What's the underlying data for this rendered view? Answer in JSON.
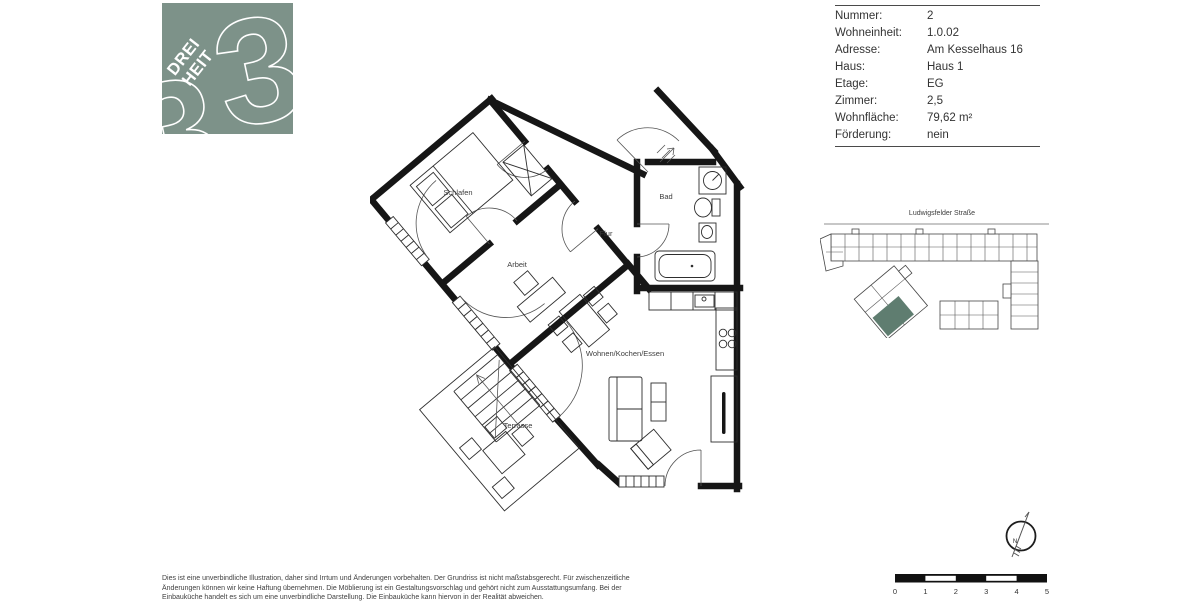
{
  "colors": {
    "logo_green": "#7D9289",
    "unit_green": "#5F7D70",
    "wall_ink": "#161616",
    "text_ink": "#3a3a3a"
  },
  "logo": {
    "line1": "DREI",
    "line2": "HEIT",
    "glyph": "3"
  },
  "info": {
    "rows": [
      {
        "label": "Nummer:",
        "value": "2"
      },
      {
        "label": "Wohneinheit:",
        "value": "1.0.02"
      },
      {
        "label": "Adresse:",
        "value": "Am Kesselhaus 16"
      },
      {
        "label": "Haus:",
        "value": "Haus 1"
      },
      {
        "label": "Etage:",
        "value": "EG"
      },
      {
        "label": "Zimmer:",
        "value": "2,5"
      },
      {
        "label": "Wohnfläche:",
        "value": "79,62 m²"
      },
      {
        "label": "Förderung:",
        "value": "nein"
      }
    ]
  },
  "floorplan": {
    "rooms": {
      "schlafen": "Schlafen",
      "arbeit": "Arbeit",
      "flur": "Flur",
      "bad": "Bad",
      "wohnen": "Wohnen/Kochen/Essen",
      "terrasse": "Terrasse"
    }
  },
  "siteplan": {
    "street": "Ludwigsfelder Straße"
  },
  "compass": {
    "north": "N"
  },
  "scalebar": {
    "labels": [
      "0",
      "1",
      "2",
      "3",
      "4",
      "5"
    ]
  },
  "footer": {
    "lines": [
      "Dies ist eine unverbindliche Illustration, daher sind Irrtum und Änderungen vorbehalten. Der Grundriss ist nicht maßstabsgerecht. Für zwischenzeitliche",
      "Änderungen können wir keine Haftung übernehmen. Die Möblierung ist ein Gestaltungsvorschlag und gehört nicht zum Ausstattungsumfang. Bei der",
      "Einbauküche handelt es sich um eine unverbindliche Darstellung. Die Einbauküche kann hiervon in der Realität abweichen."
    ]
  }
}
